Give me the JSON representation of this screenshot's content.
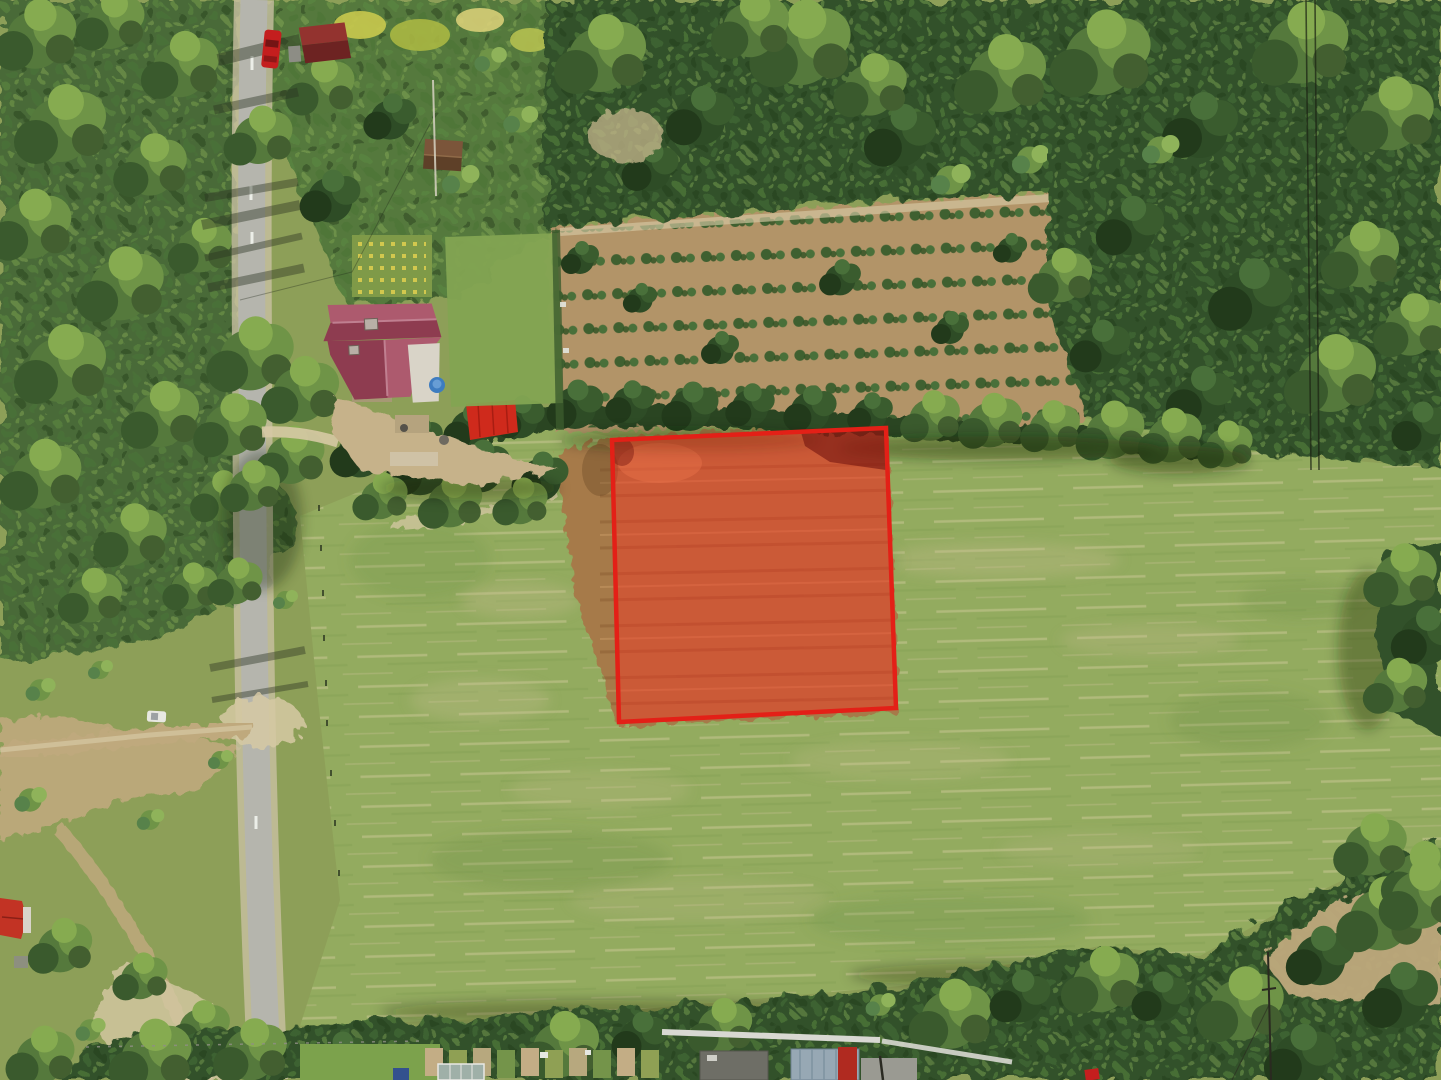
{
  "image": {
    "kind": "aerial-drone-photo",
    "subject": "Aerial drone view of a rural land parcel for sale, marked with a semi-transparent red boundary overlay, surrounded by meadow, forest, a country road and homesteads",
    "width": 1441,
    "height": 1080
  },
  "colors": {
    "scrub": "#8d9f58",
    "field_base": "#93ab5f",
    "field_dark_patch": "#6f9347",
    "field_dry_patch": "#c7bd8f",
    "mow_streak": "#d3cb9c",
    "forest_dark": "#31512a",
    "forest_left": "#4a6b38",
    "forest_mid": "#55793c",
    "conifer": "#2a4522",
    "deep_shadow": "#15260f",
    "road_asphalt": "#b5b5ad",
    "road_shoulder": "#c9c0a3",
    "road_marking": "#eceee8",
    "dirt": "#bfa97d",
    "dirt_light": "#d6c9a4",
    "plantation_dirt": "#b29467",
    "plot_ground": "#a67a4a",
    "plot_fill": "#ff2d1f",
    "plot_stroke": "#e32017",
    "plot_shadow": "#6b0f0d",
    "house_roof_light": "#ad5a6e",
    "house_roof_dark": "#8e3c50",
    "house_wall": "#d9d4c8",
    "awning_red": "#cf2a1c",
    "cabin_roof": "#93332f",
    "cabin_roof_dark": "#6d2322",
    "shed_roof": "#7b553a",
    "shed_roof_dark": "#5e4028",
    "pool_blue": "#3e7cc0",
    "car_red": "#c41e1e",
    "car_white": "#e8e8e2",
    "metal_roof": "#97a8b4",
    "barn_red": "#b02a20",
    "structure_white": "#d8d8d2",
    "structure_gray": "#9a9a92",
    "gravel": "#c6b28a",
    "flowers_yellow": "#d2c84e",
    "left_house_roof": "#c23324",
    "powerline": "#1c2414",
    "lawn": "#83a452"
  },
  "plot_overlay": {
    "label": "highlighted parcel boundary",
    "corners": "612,440 886,428 896,708 619,722",
    "fill_opacity": 0.42,
    "stroke_width": 4.5
  },
  "scene": {
    "features": [
      "dense mixed forest along the left side and the whole upper right quadrant",
      "asphalt country road running north-south on the left with tree shadows",
      "dirt side road branching west with a white parked car",
      "house with dark pink cross-gabled roof, white walls, gravel yard",
      "bright red garden awning and small blue pool beside the house",
      "dark red garden cabin and red car parked on the road at top left",
      "small wooden shed in the garden",
      "rows of young plantation trees on tan soil in the upper middle",
      "large green meadow with horizontal mowing streaks",
      "dry brown hay parcel highlighted by the red overlay",
      "tree line with conifers directly above the highlighted parcel",
      "farm buildings with metal, red and gray roofs along the bottom",
      "greenhouse, blue tarp and garden beds at the bottom left",
      "overhead power lines crossing the forest at top right and a pole at bottom right",
      "red-roofed house clipped at the far left edge",
      "dirt clearing wedge at the bottom right corner"
    ]
  }
}
